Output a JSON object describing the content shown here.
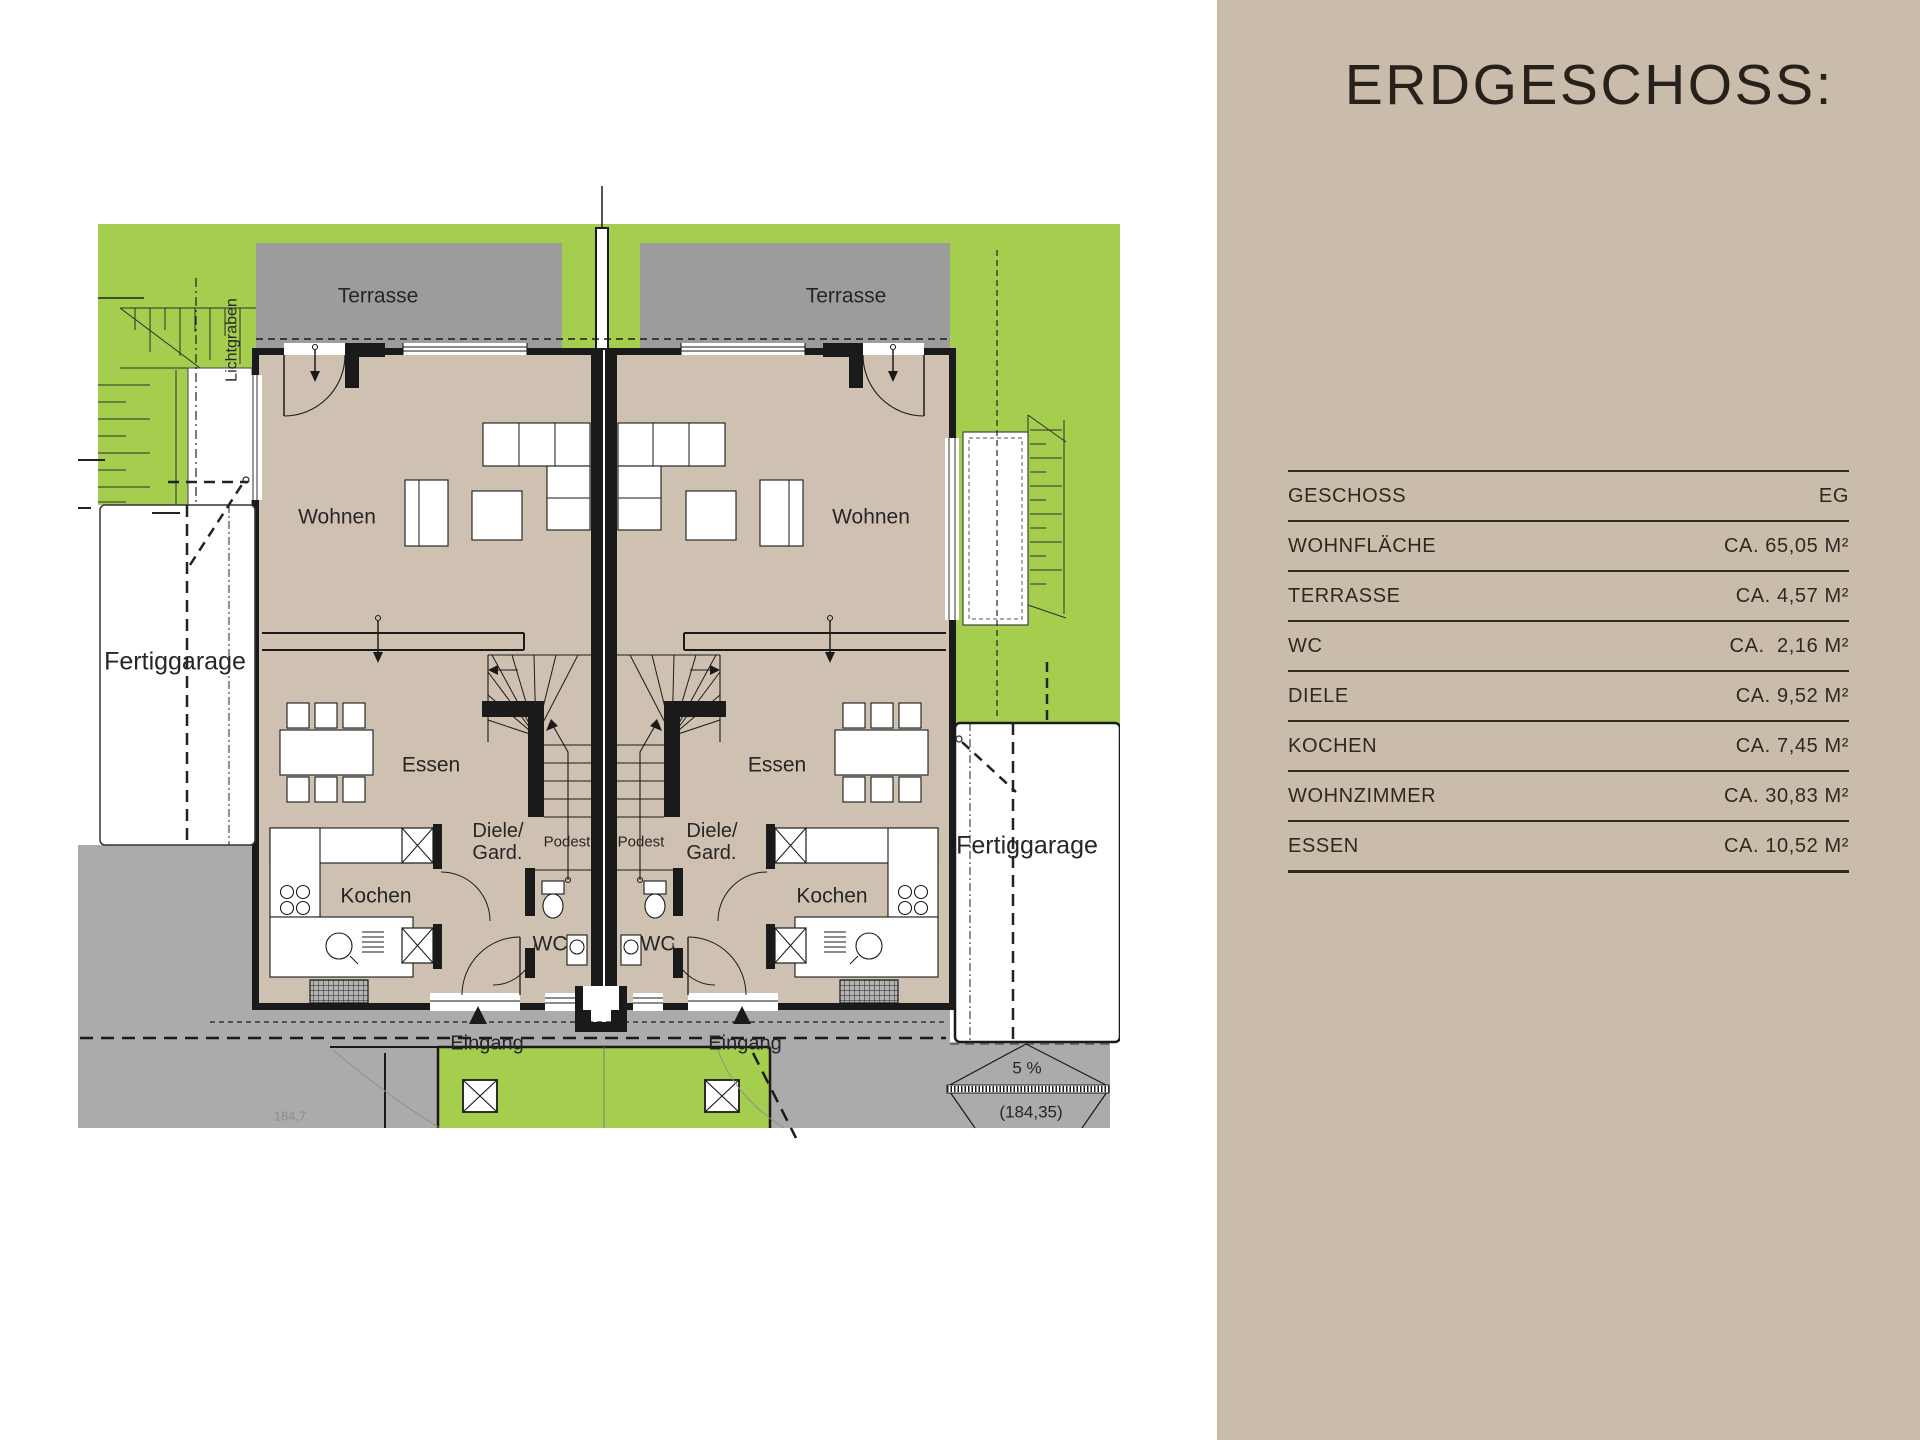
{
  "panel": {
    "title": "ERDGESCHOSS:",
    "table": {
      "rows": [
        {
          "label": "GESCHOSS",
          "value": "EG"
        },
        {
          "label": "WOHNFLÄCHE",
          "value": "CA. 65,05 M²"
        },
        {
          "label": "TERRASSE",
          "value": "CA. 4,57 M²"
        },
        {
          "label": "WC",
          "value": "CA.  2,16 M²"
        },
        {
          "label": "DIELE",
          "value": "CA. 9,52 M²"
        },
        {
          "label": "KOCHEN",
          "value": "CA. 7,45 M²"
        },
        {
          "label": "WOHNZIMMER",
          "value": "CA. 30,83 M²"
        },
        {
          "label": "ESSEN",
          "value": "CA. 10,52 M²"
        }
      ]
    }
  },
  "plan": {
    "labels": {
      "terrasse": "Terrasse",
      "wohnen": "Wohnen",
      "essen": "Essen",
      "diele_line1": "Diele/",
      "diele_line2": "Gard.",
      "podest": "Podest",
      "kochen": "Kochen",
      "wc": "WC",
      "eingang": "Eingang",
      "fertiggarage": "Fertiggarage",
      "lichtgraben": "Lichtgraben",
      "slope": "5 %",
      "elevation": "(184,35)",
      "ground_elevation": "184,7"
    },
    "colors": {
      "lawn": "#a6ce4e",
      "terrace_gray": "#9c9c9c",
      "interior_beige": "#cfc1b2",
      "paving_gray": "#ababab",
      "wall_black": "#1a1a1a",
      "panel_beige": "#c9bcab"
    }
  }
}
